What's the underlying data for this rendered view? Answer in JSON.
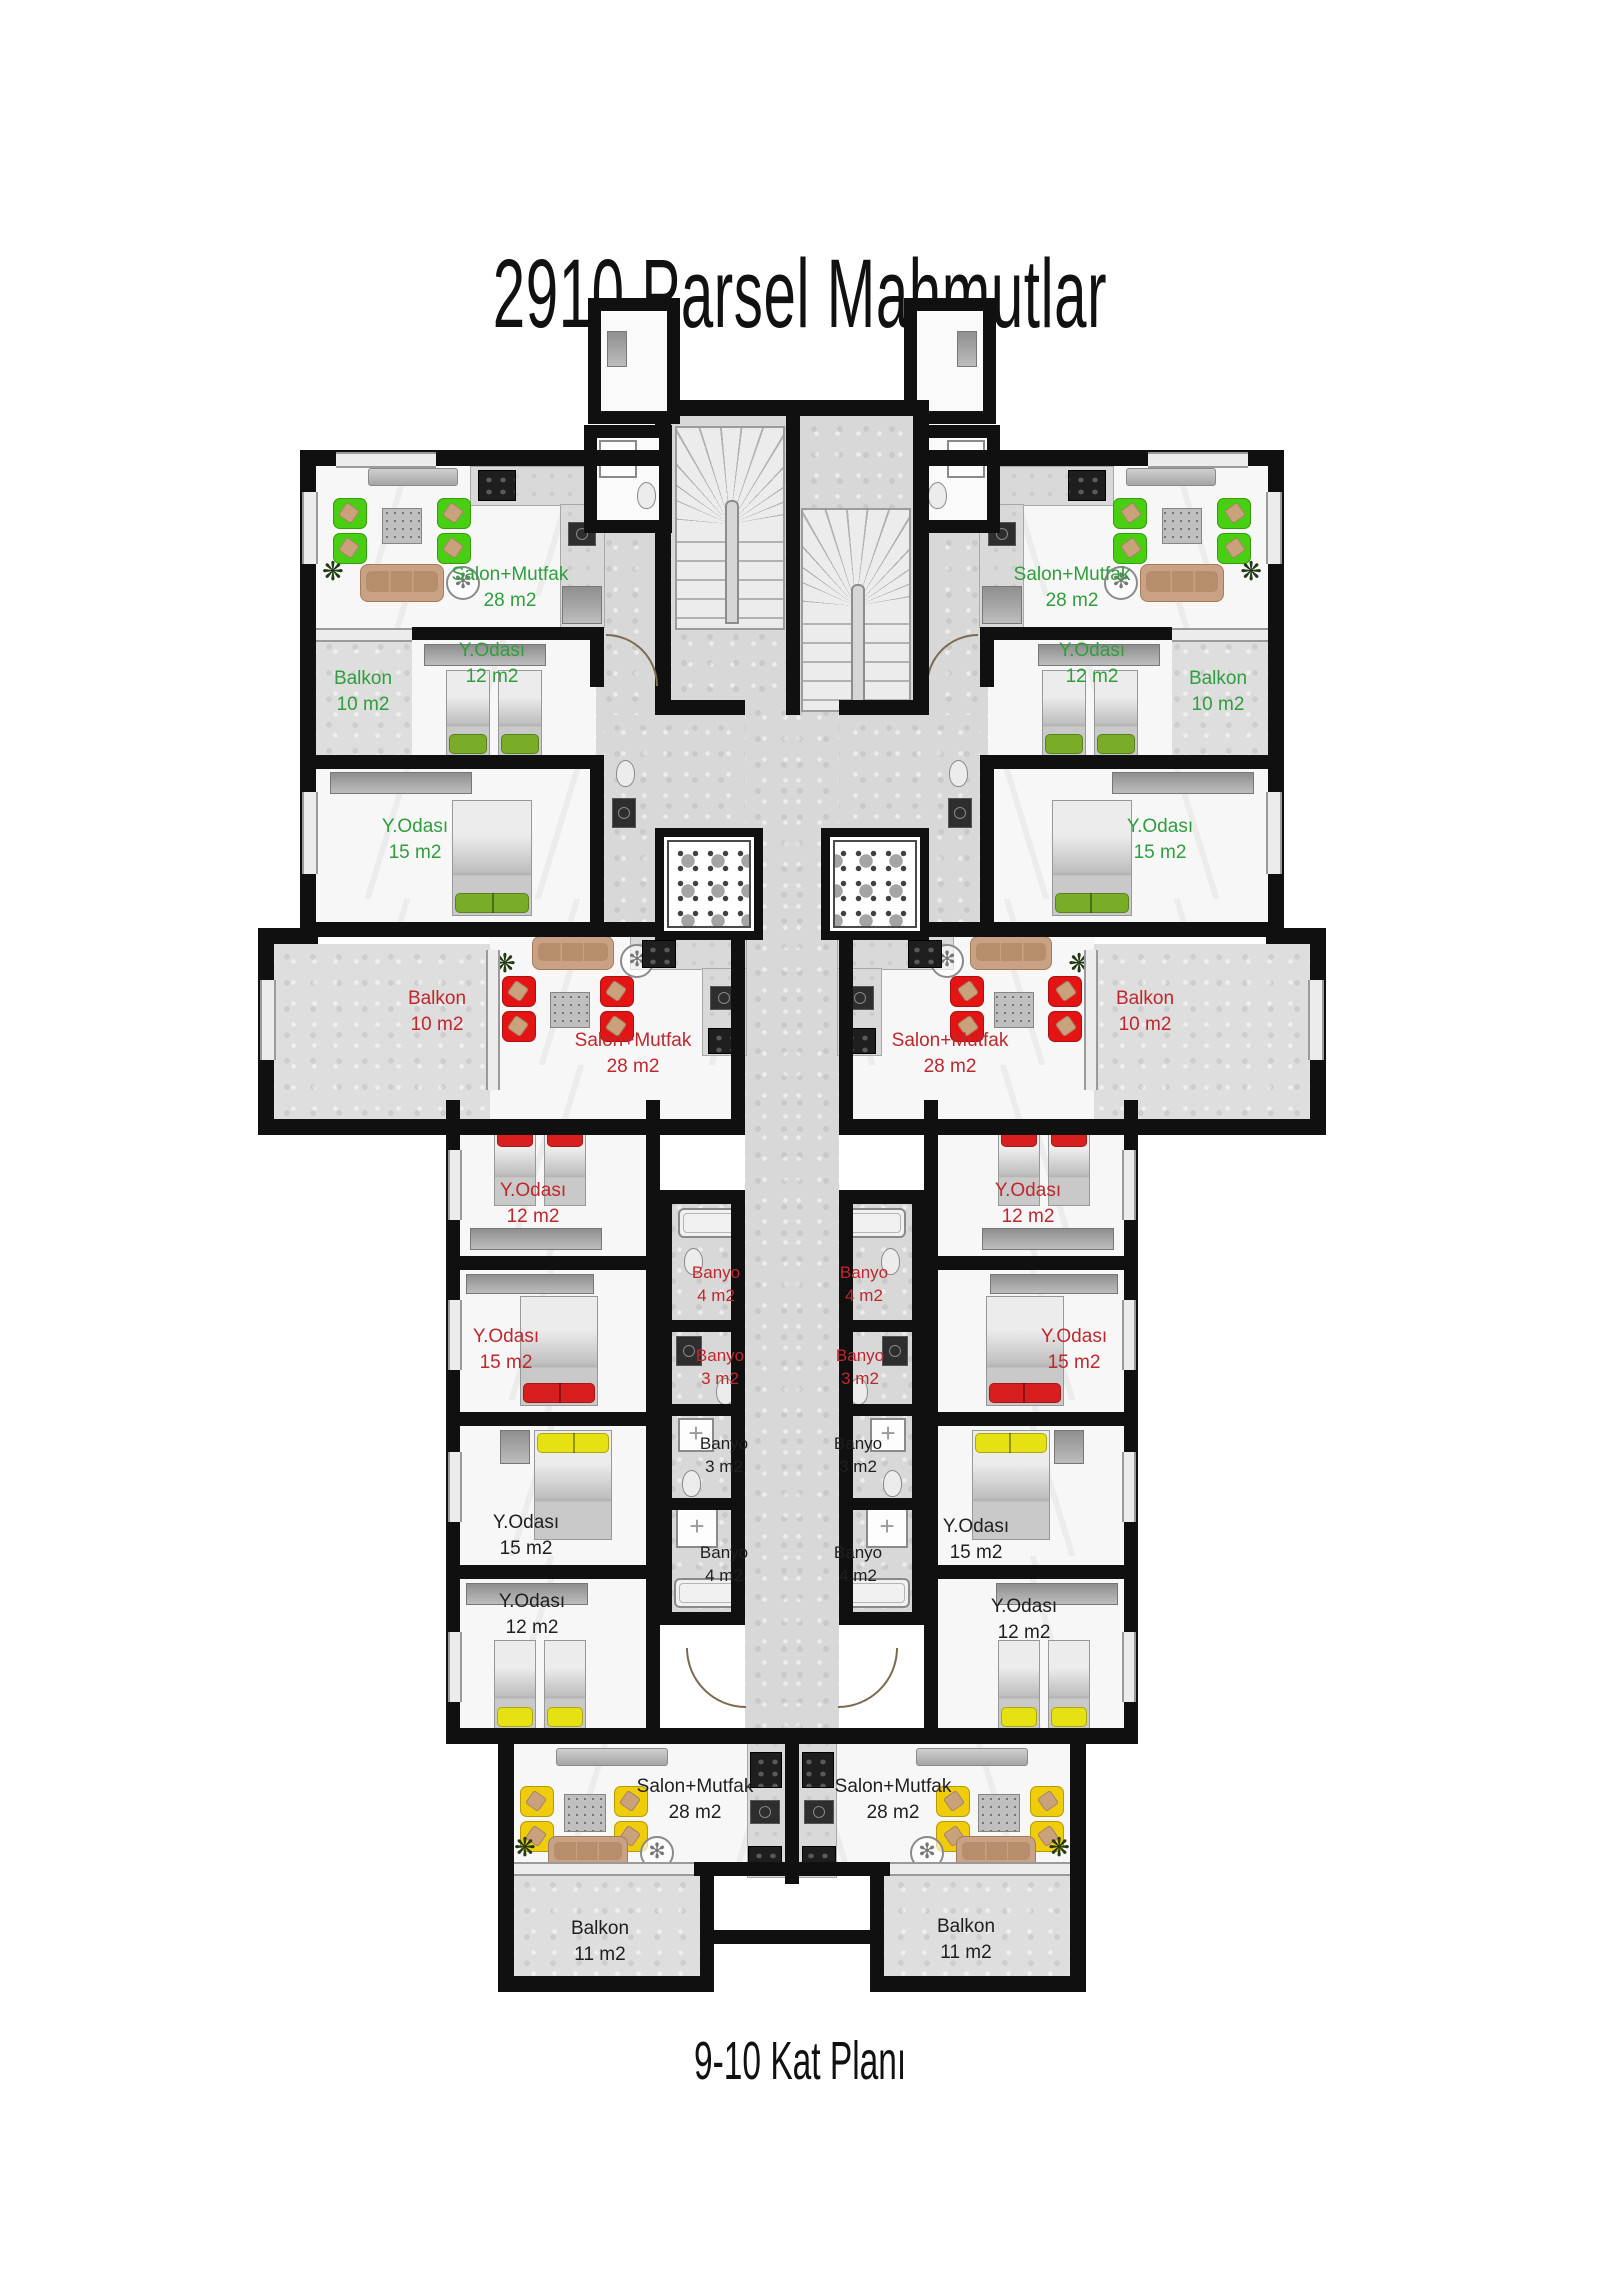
{
  "title": "2910 Parsel Mahmutlar",
  "caption": "9-10 Kat Planı",
  "colors": {
    "green": "#2f9e3c",
    "red": "#c0272d",
    "black": "#1f1f1f"
  },
  "rooms": [
    {
      "id": "salon-top-left",
      "name": "Salon+Mutfak",
      "area": "28 m2",
      "color": "green",
      "x": 510,
      "y": 588
    },
    {
      "id": "yodasi12-top-left",
      "name": "Y.Odası",
      "area": "12 m2",
      "color": "green",
      "x": 492,
      "y": 664
    },
    {
      "id": "balkon10-top-left",
      "name": "Balkon",
      "area": "10 m2",
      "color": "green",
      "x": 363,
      "y": 692
    },
    {
      "id": "salon-top-right",
      "name": "Salon+Mutfak",
      "area": "28 m2",
      "color": "green",
      "x": 1072,
      "y": 588
    },
    {
      "id": "yodasi12-top-right",
      "name": "Y.Odası",
      "area": "12 m2",
      "color": "green",
      "x": 1092,
      "y": 664
    },
    {
      "id": "balkon10-top-right",
      "name": "Balkon",
      "area": "10 m2",
      "color": "green",
      "x": 1218,
      "y": 692
    },
    {
      "id": "yodasi15-upper-left",
      "name": "Y.Odası",
      "area": "15 m2",
      "color": "green",
      "x": 415,
      "y": 840
    },
    {
      "id": "yodasi15-upper-right",
      "name": "Y.Odası",
      "area": "15 m2",
      "color": "green",
      "x": 1160,
      "y": 840
    },
    {
      "id": "balkon10-mid-left",
      "name": "Balkon",
      "area": "10 m2",
      "color": "red",
      "x": 437,
      "y": 1012
    },
    {
      "id": "balkon10-mid-right",
      "name": "Balkon",
      "area": "10 m2",
      "color": "red",
      "x": 1145,
      "y": 1012
    },
    {
      "id": "salon-mid-left",
      "name": "Salon+Mutfak",
      "area": "28 m2",
      "color": "red",
      "x": 633,
      "y": 1054
    },
    {
      "id": "salon-mid-right",
      "name": "Salon+Mutfak",
      "area": "28 m2",
      "color": "red",
      "x": 950,
      "y": 1054
    },
    {
      "id": "yodasi12-mid-left",
      "name": "Y.Odası",
      "area": "12 m2",
      "color": "red",
      "x": 533,
      "y": 1204
    },
    {
      "id": "yodasi12-mid-right",
      "name": "Y.Odası",
      "area": "12 m2",
      "color": "red",
      "x": 1028,
      "y": 1204
    },
    {
      "id": "banyo4-red-left",
      "name": "Banyo",
      "area": "4 m2",
      "color": "red",
      "small": true,
      "x": 716,
      "y": 1284
    },
    {
      "id": "banyo4-red-right",
      "name": "Banyo",
      "area": "4 m2",
      "color": "red",
      "small": true,
      "x": 864,
      "y": 1284
    },
    {
      "id": "yodasi15-red-left",
      "name": "Y.Odası",
      "area": "15 m2",
      "color": "red",
      "x": 506,
      "y": 1350
    },
    {
      "id": "yodasi15-red-right",
      "name": "Y.Odası",
      "area": "15 m2",
      "color": "red",
      "x": 1074,
      "y": 1350
    },
    {
      "id": "banyo3-red-left",
      "name": "Banyo",
      "area": "3 m2",
      "color": "red",
      "small": true,
      "x": 720,
      "y": 1367
    },
    {
      "id": "banyo3-red-right",
      "name": "Banyo",
      "area": "3 m2",
      "color": "red",
      "small": true,
      "x": 860,
      "y": 1367
    },
    {
      "id": "banyo3-black-left",
      "name": "Banyo",
      "area": "3 m2",
      "color": "black",
      "small": true,
      "x": 724,
      "y": 1455
    },
    {
      "id": "banyo3-black-right",
      "name": "Banyo",
      "area": "3 m2",
      "color": "black",
      "small": true,
      "x": 858,
      "y": 1455
    },
    {
      "id": "yodasi15-black-left",
      "name": "Y.Odası",
      "area": "15 m2",
      "color": "black",
      "x": 526,
      "y": 1536
    },
    {
      "id": "yodasi15-black-right",
      "name": "Y.Odası",
      "area": "15 m2",
      "color": "black",
      "x": 976,
      "y": 1540
    },
    {
      "id": "banyo4-black-left",
      "name": "Banyo",
      "area": "4 m2",
      "color": "black",
      "small": true,
      "x": 724,
      "y": 1564
    },
    {
      "id": "banyo4-black-right",
      "name": "Banyo",
      "area": "4 m2",
      "color": "black",
      "small": true,
      "x": 858,
      "y": 1564
    },
    {
      "id": "yodasi12-black-left",
      "name": "Y.Odası",
      "area": "12 m2",
      "color": "black",
      "x": 532,
      "y": 1615
    },
    {
      "id": "yodasi12-black-right",
      "name": "Y.Odası",
      "area": "12 m2",
      "color": "black",
      "x": 1024,
      "y": 1620
    },
    {
      "id": "salon-bottom-left",
      "name": "Salon+Mutfak",
      "area": "28 m2",
      "color": "black",
      "x": 695,
      "y": 1800
    },
    {
      "id": "salon-bottom-right",
      "name": "Salon+Mutfak",
      "area": "28 m2",
      "color": "black",
      "x": 893,
      "y": 1800
    },
    {
      "id": "balkon11-left",
      "name": "Balkon",
      "area": "11 m2",
      "color": "black",
      "x": 600,
      "y": 1942
    },
    {
      "id": "balkon11-right",
      "name": "Balkon",
      "area": "11 m2",
      "color": "black",
      "x": 966,
      "y": 1940
    }
  ]
}
